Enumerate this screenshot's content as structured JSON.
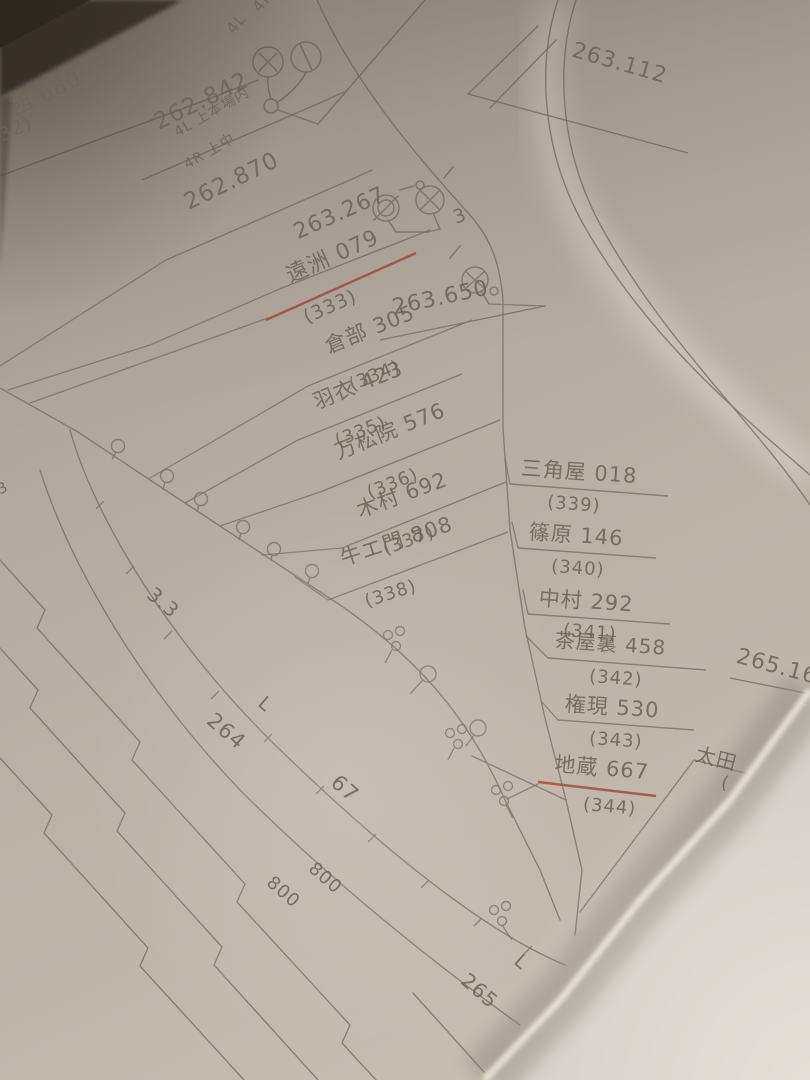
{
  "photo": {
    "description": "Photograph of a folded paper sheet with a hand-drawn Japanese railway kilometrage and level-crossing diagram"
  },
  "markers": {
    "m262842": "262.842",
    "m262870": "262.870",
    "m263112": "263.112",
    "m263267": "263.267",
    "m263650": "263.650",
    "m265160": "265.160"
  },
  "signals": {
    "r4": "4R",
    "l4": "4L",
    "home_l": "4L 上本場内",
    "home_r": "4R 上中",
    "aux3": "3"
  },
  "crossings": {
    "c332": {
      "name": "西 680",
      "num": "(332)"
    },
    "c333": {
      "name": "遠洲 079",
      "num": "(333)"
    },
    "c334": {
      "name": "倉部 305",
      "num": "(334)"
    },
    "c335": {
      "name": "羽衣 423",
      "num": "(335)"
    },
    "c336": {
      "name": "万松院 576",
      "num": "(336)"
    },
    "c337": {
      "name": "木村 692",
      "num": "(337)"
    },
    "c338": {
      "name": "牛エ門 808",
      "num": "(338)"
    },
    "c339": {
      "name": "三角屋 018",
      "num": "(339)"
    },
    "c340": {
      "name": "篠原 146",
      "num": "(340)"
    },
    "c341": {
      "name": "中村 292",
      "num": "(341)"
    },
    "c342": {
      "name": "茶屋裏 458",
      "num": "(342)"
    },
    "c343": {
      "name": "権現 530",
      "num": "(343)"
    },
    "c344": {
      "name": "地蔵 667",
      "num": "(344)"
    }
  },
  "station": {
    "oota": "太田",
    "oota_paren": "("
  },
  "ruler": {
    "grade": "3.3",
    "km264": "264",
    "len67": "67",
    "len800a": "800",
    "len800b": "800",
    "km265": "265",
    "l1": "L",
    "l2": "L",
    "edge_partial": "3"
  },
  "colors": {
    "ink": "#6f6557",
    "red_ink": "#a6463c",
    "paper": "#b7aea2"
  }
}
